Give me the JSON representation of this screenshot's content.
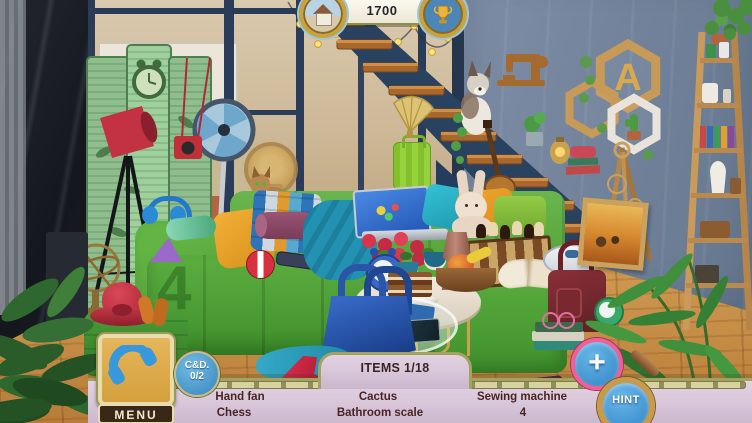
{
  "hud": {
    "score": "1700",
    "medals": {
      "left": "house-photo-medal",
      "right": "trophy-medal"
    },
    "items_panel": {
      "header": "ITEMS 1/18",
      "rows": [
        [
          "Hand fan",
          "Cactus",
          "Sewing machine"
        ],
        [
          "Chess",
          "Bathroom scale",
          "4"
        ]
      ]
    },
    "menu": {
      "label": "MENU"
    },
    "cd_badge": {
      "title": "C&D.",
      "count": "0/2"
    },
    "plus": {
      "label": "+"
    },
    "hint": {
      "label": "HINT"
    }
  },
  "scene": {
    "sofa_number": "4",
    "shelf_letter": "A",
    "hidden_items_visible": [
      "Hand fan",
      "Cactus",
      "Sewing machine",
      "Chess",
      "Bathroom scale",
      "4"
    ]
  },
  "colors": {
    "panel_bg": "#d9c7da",
    "panel_border": "#a3a35f",
    "label_text": "#4a2323",
    "button_blue": "#3f97d4",
    "plus_ring": "#ef5f98",
    "hint_ring": "#c89a4c",
    "menu_gold": "#dfaf4e",
    "menu_bar": "#3a2817",
    "sofa_green": "#57a83c",
    "wall_blue": "#72839b",
    "floor_wood": "#c08a44",
    "screen_green": "#8fbd8d",
    "banner_cream": "#f6f2e6"
  }
}
